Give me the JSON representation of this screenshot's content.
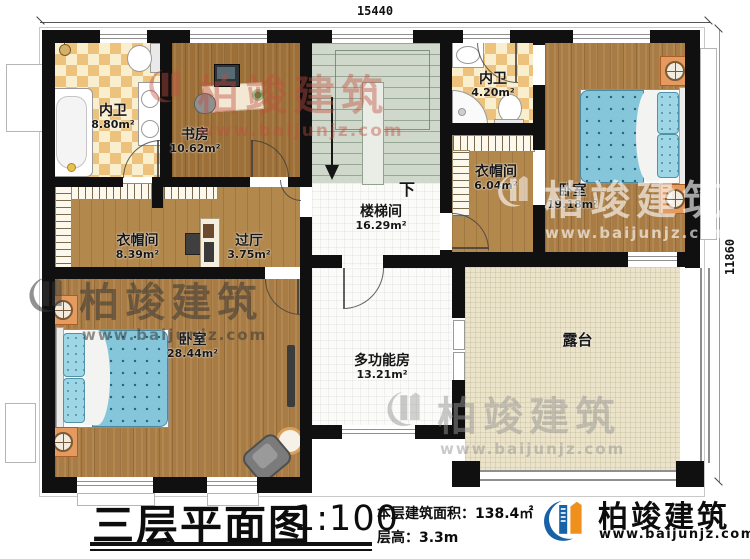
{
  "plan": {
    "dimensions": {
      "top": "15440",
      "right": "11860"
    },
    "stair": {
      "direction_label": "下"
    },
    "rooms": {
      "bath1": {
        "name": "内卫",
        "area": "8.80m²"
      },
      "study": {
        "name": "书房",
        "area": "10.62m²"
      },
      "stairwell": {
        "name": "楼梯间",
        "area": "16.29m²"
      },
      "bath2": {
        "name": "内卫",
        "area": "4.20m²"
      },
      "closet2": {
        "name": "衣帽间",
        "area": "6.04m²"
      },
      "bedroom2": {
        "name": "卧室",
        "area": "19.18m²"
      },
      "closet1": {
        "name": "衣帽间",
        "area": "8.39m²"
      },
      "hall": {
        "name": "过厅",
        "area": "3.75m²"
      },
      "bedroom1": {
        "name": "卧室",
        "area": "28.44m²"
      },
      "multi": {
        "name": "多功能房",
        "area": "13.21m²"
      },
      "terrace": {
        "name": "露台",
        "area": ""
      }
    }
  },
  "titleblock": {
    "title": "三层平面图",
    "scale": "1:100",
    "area_line": "本层建筑面积：138.4㎡",
    "height_line": "层高：3.3m"
  },
  "brand": {
    "name": "柏竣建筑",
    "url": "www.baijunjz.com",
    "colors": {
      "blue": "#1761a8",
      "orange": "#ef8f1c"
    }
  }
}
